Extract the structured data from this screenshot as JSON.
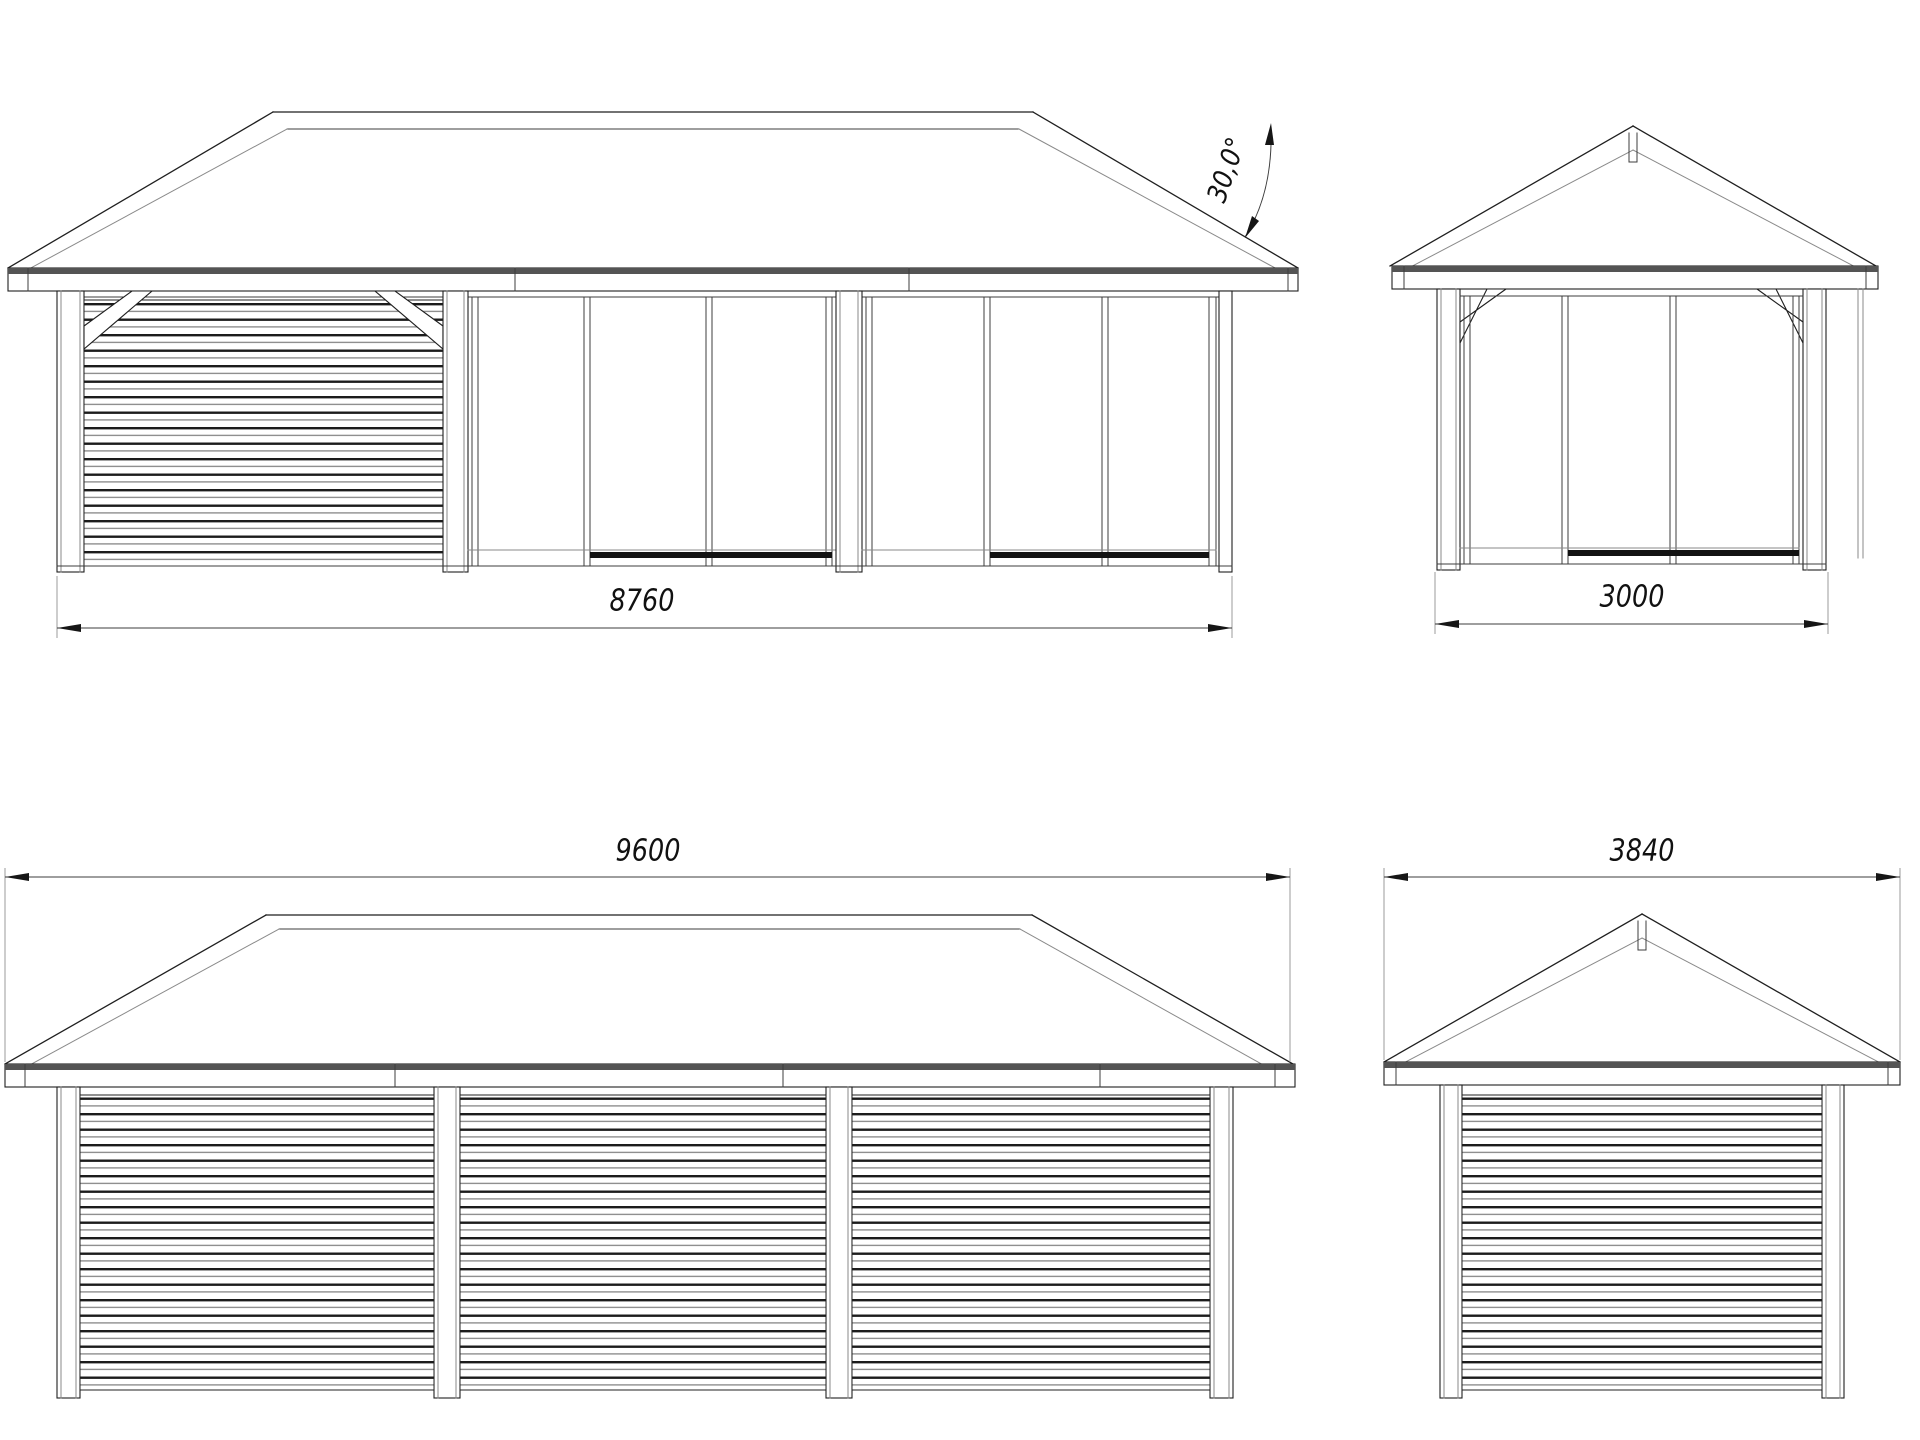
{
  "drawing": {
    "front_view": {
      "width_label": "8760",
      "roof_angle_label": "30,0°"
    },
    "side_view_top": {
      "width_label": "3000"
    },
    "rear_view": {
      "width_label": "9600"
    },
    "side_view_bottom": {
      "width_label": "3840"
    }
  },
  "colors": {
    "line": "#1f1f1f",
    "roof_edge_shade": "#545454",
    "glass_track": "#121212",
    "background": "#ffffff"
  }
}
